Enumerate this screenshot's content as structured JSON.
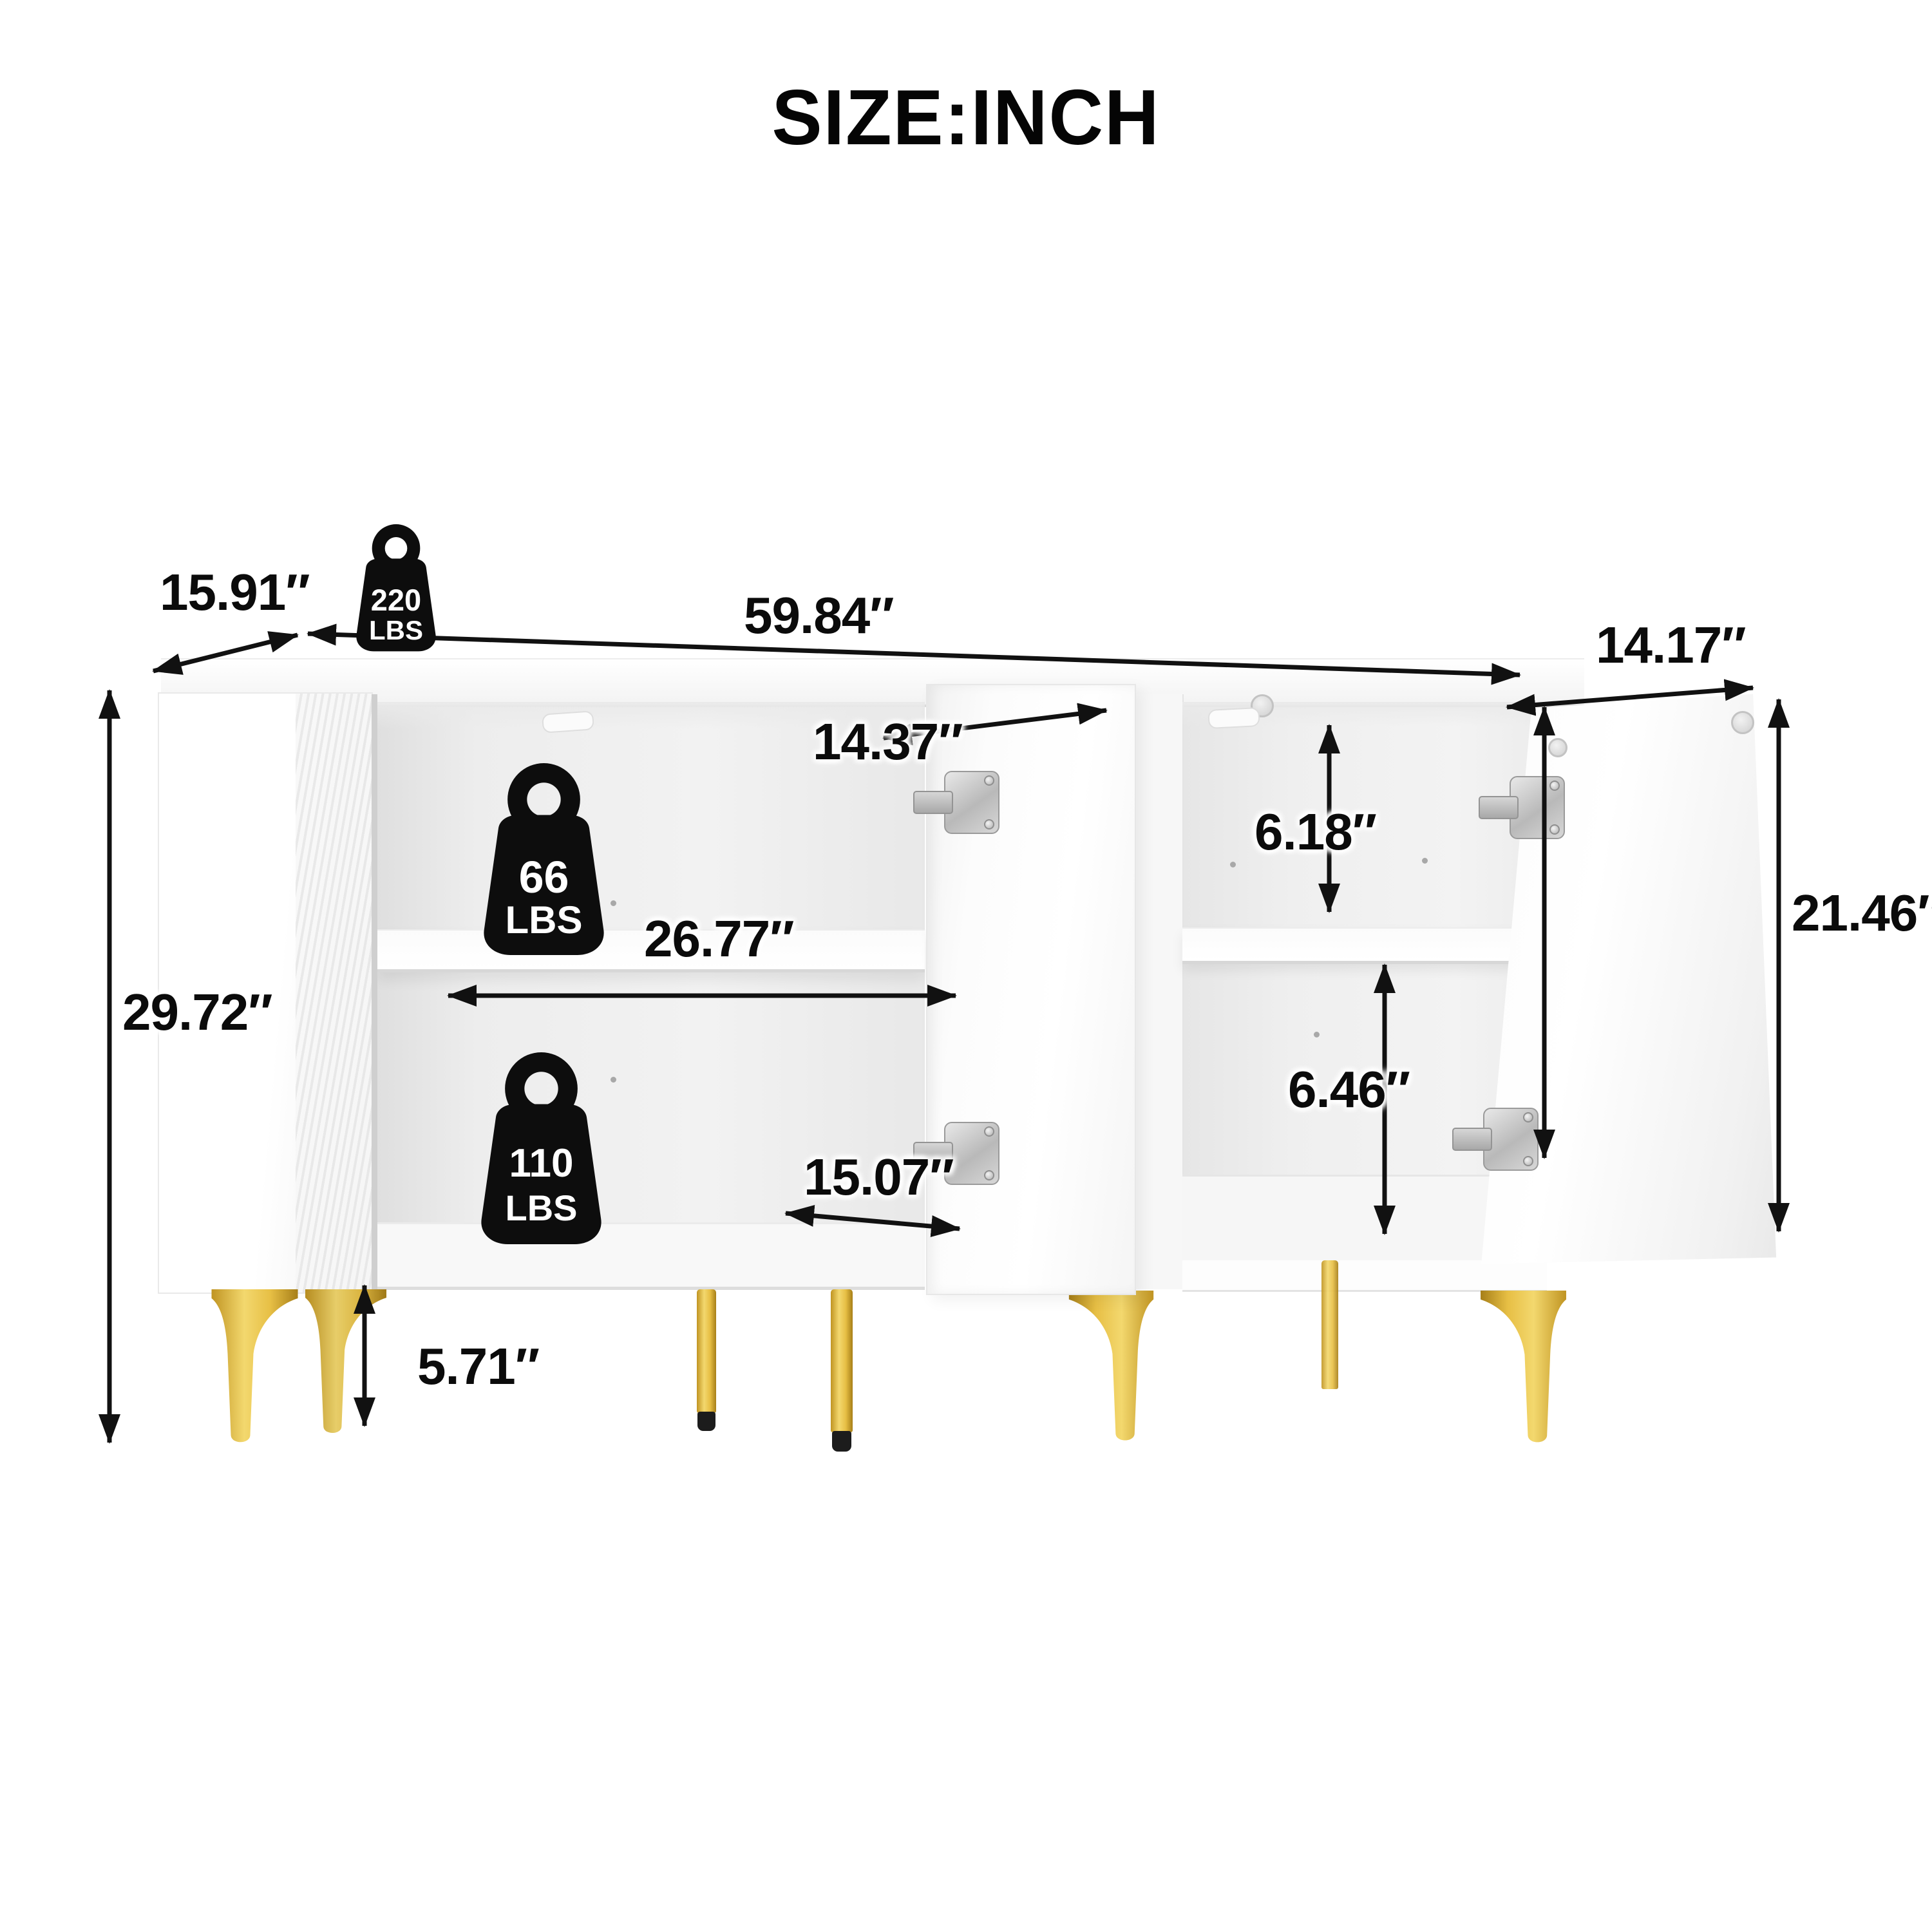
{
  "title": "SIZE:INCH",
  "dimensions": {
    "overall_width": "59.84″",
    "overall_depth": "15.91″",
    "overall_height": "29.72″",
    "left_opening_top_width": "14.37″",
    "shelf_span_width": "26.77″",
    "left_opening_bottom_width": "15.07″",
    "right_upper_opening_height": "6.18″",
    "right_lower_opening_height": "6.46″",
    "door_width": "14.17″",
    "door_height": "21.46″",
    "leg_height": "5.71″"
  },
  "weight_capacities": {
    "top_panel": {
      "value": "220",
      "unit": "LBS"
    },
    "shelf": {
      "value": "66",
      "unit": "LBS"
    },
    "bottom_panel": {
      "value": "110",
      "unit": "LBS"
    }
  },
  "style": {
    "arrow_color": "#111111",
    "text_color": "#0b0b0b",
    "gold_leg_color": "#e7bf45",
    "leg_foot_color": "#1c1c1c",
    "cabinet_color": "#ffffff"
  }
}
